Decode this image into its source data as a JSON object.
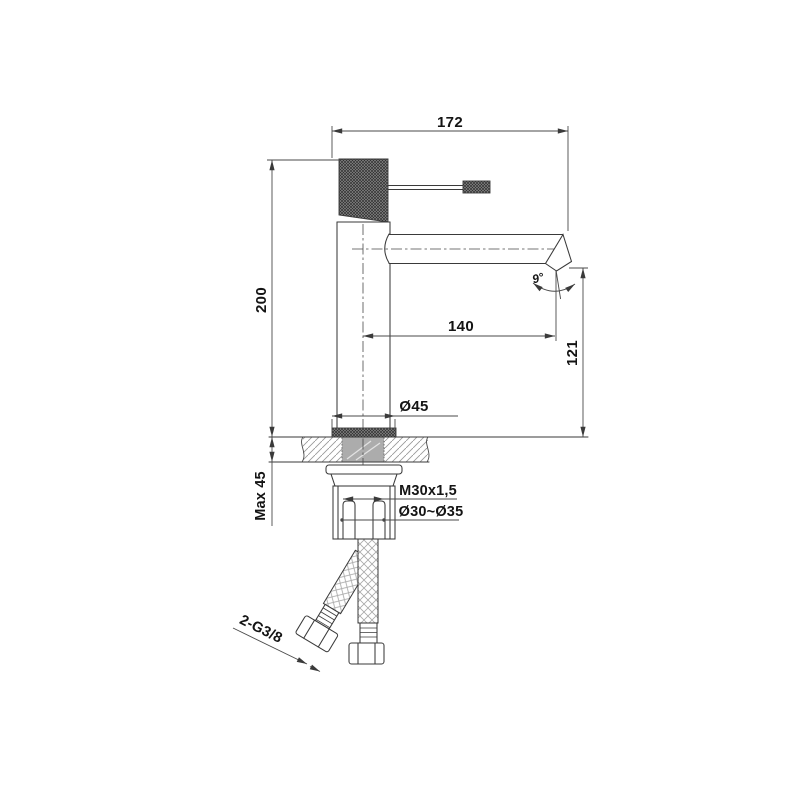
{
  "drawing": {
    "type": "technical_drawing",
    "dimensions": {
      "top_width": "172",
      "total_height": "200",
      "spout_reach": "140",
      "outlet_height": "121",
      "base_diameter": "Ø45",
      "max_counter_thickness": "Max 45",
      "mounting_thread": "M30x1,5",
      "hole_diameter_range": "Ø30~Ø35",
      "spout_angle": "9°",
      "hose_connections": "2-G3/8"
    },
    "colors": {
      "line": "#3a3a3a",
      "dim-line": "#4a4a4a",
      "text": "#141414",
      "shank-fill": "#acacac",
      "background": "#ffffff"
    }
  }
}
